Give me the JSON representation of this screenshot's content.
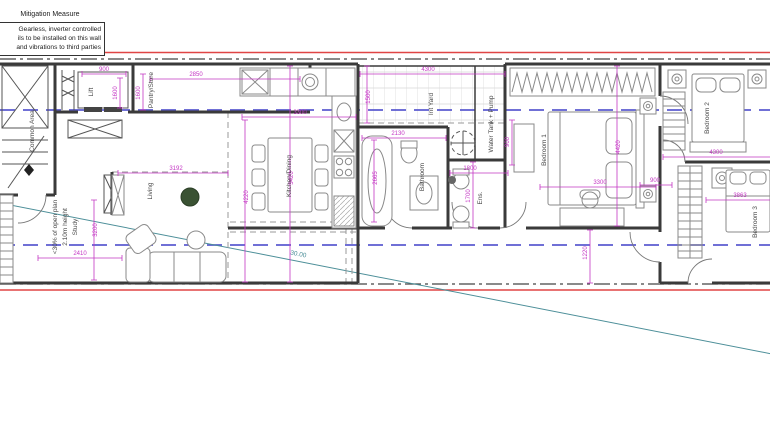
{
  "note_box": {
    "title": "Mitigation Measure",
    "lines": [
      "Gearless, inverter controlled",
      "ils to be installed on this wall",
      "and vibrations to third parties"
    ]
  },
  "plan": {
    "room_labels": [
      {
        "text": "Common Area",
        "x": 34,
        "y": 131,
        "rot": -90
      },
      {
        "text": "Lift",
        "x": 93,
        "y": 92,
        "rot": -90
      },
      {
        "text": "Pantry/Store",
        "x": 153,
        "y": 90,
        "rot": -90
      },
      {
        "text": "Kitchen/Dining",
        "x": 291,
        "y": 176,
        "rot": -90
      },
      {
        "text": "Living",
        "x": 152,
        "y": 191,
        "rot": -90
      },
      {
        "text": "<30% of open plan",
        "x": 57,
        "y": 227,
        "rot": -90
      },
      {
        "text": "2.10m height",
        "x": 67,
        "y": 227,
        "rot": -90
      },
      {
        "text": "Study",
        "x": 77,
        "y": 227,
        "rot": -90
      },
      {
        "text": "Bathroom",
        "x": 424,
        "y": 177,
        "rot": -90
      },
      {
        "text": "Int Yard",
        "x": 433,
        "y": 104,
        "rot": -90
      },
      {
        "text": "Water Tank + Pump",
        "x": 493,
        "y": 124,
        "rot": -90
      },
      {
        "text": "Ens.",
        "x": 482,
        "y": 198,
        "rot": -90
      },
      {
        "text": "Bedroom 1",
        "x": 546,
        "y": 150,
        "rot": -90
      },
      {
        "text": "Bedroom 2",
        "x": 709,
        "y": 118,
        "rot": -90
      },
      {
        "text": "Bedroom 3",
        "x": 757,
        "y": 222,
        "rot": -90
      }
    ],
    "dimensions": [
      {
        "text": "900",
        "x": 104,
        "y": 71,
        "rot": 0
      },
      {
        "text": "1600",
        "x": 117,
        "y": 93,
        "rot": -90
      },
      {
        "text": "1600",
        "x": 140,
        "y": 93,
        "rot": -90
      },
      {
        "text": "2850",
        "x": 196,
        "y": 76,
        "rot": 0
      },
      {
        "text": "3192",
        "x": 176,
        "y": 170,
        "rot": 0
      },
      {
        "text": "3300",
        "x": 300,
        "y": 114,
        "rot": 0
      },
      {
        "text": "4220",
        "x": 248,
        "y": 197,
        "rot": -90
      },
      {
        "text": "5420",
        "x": 293,
        "y": 178,
        "rot": -90
      },
      {
        "text": "2410",
        "x": 80,
        "y": 255,
        "rot": 0
      },
      {
        "text": "3200",
        "x": 97,
        "y": 230,
        "rot": -90
      },
      {
        "text": "4300",
        "x": 428,
        "y": 71,
        "rot": 0
      },
      {
        "text": "1500",
        "x": 370,
        "y": 97,
        "rot": -90
      },
      {
        "text": "2130",
        "x": 398,
        "y": 135,
        "rot": 0
      },
      {
        "text": "2665",
        "x": 377,
        "y": 178,
        "rot": -90
      },
      {
        "text": "1800",
        "x": 470,
        "y": 170,
        "rot": 0
      },
      {
        "text": "1700",
        "x": 470,
        "y": 196,
        "rot": -90
      },
      {
        "text": "900",
        "x": 509,
        "y": 142,
        "rot": -90
      },
      {
        "text": "3300",
        "x": 600,
        "y": 184,
        "rot": 0
      },
      {
        "text": "4420",
        "x": 620,
        "y": 147,
        "rot": -90
      },
      {
        "text": "4300",
        "x": 716,
        "y": 154,
        "rot": 0
      },
      {
        "text": "3863",
        "x": 740,
        "y": 197,
        "rot": 0
      },
      {
        "text": "900",
        "x": 655,
        "y": 182,
        "rot": 0
      },
      {
        "text": "1220",
        "x": 587,
        "y": 253,
        "rot": -90
      }
    ],
    "survey_labels": [
      {
        "text": "30.00",
        "x": 298,
        "y": 256,
        "rot": 11
      }
    ],
    "colors": {
      "wall": "#3a3a3a",
      "dimension": "#c437c4",
      "section_line": "#5c5cd0",
      "boundary_red": "#e04545",
      "survey_teal": "#4d8f99"
    }
  }
}
